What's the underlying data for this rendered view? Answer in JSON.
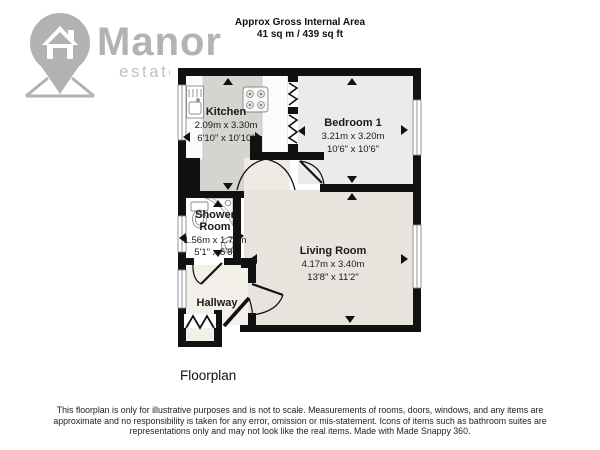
{
  "header": {
    "title": "Approx Gross Internal Area",
    "area": "41 sq m / 439 sq ft"
  },
  "logo": {
    "name": "Manor",
    "tagline": "estate agents"
  },
  "rooms": {
    "kitchen": {
      "name": "Kitchen",
      "metric": "2.09m x 3.30m",
      "imperial": "6'10\" x 10'10\""
    },
    "bedroom1": {
      "name": "Bedroom 1",
      "metric": "3.21m x 3.20m",
      "imperial": "10'6\" x 10'6\""
    },
    "shower": {
      "name_line1": "Shower",
      "name_line2": "Room",
      "metric": "1.56m x 1.72m",
      "imperial": "5'1\" x 5'8\""
    },
    "living": {
      "name": "Living Room",
      "metric": "4.17m x 3.40m",
      "imperial": "13'8\" x 11'2\""
    },
    "hallway": {
      "name": "Hallway"
    }
  },
  "caption": "Floorplan",
  "disclaimer": "This floorplan is only for illustrative purposes and is not to scale. Measurements of rooms, doors, windows, and any items are approximate and no responsibility is taken for any error, omission or mis-statement. Icons of items such as bathroom suites are representations only and may not look like the real items. Made with Made Snappy 360.",
  "colors": {
    "wall": "#111111",
    "kitchen_floor": "#d5d4d1",
    "bedroom_floor": "#ebebe9",
    "living_floor": "#e8e4dd",
    "nook_floor": "#efebe4",
    "hallway_floor": "#f3f0e9",
    "shower_floor": "#ffffff",
    "logo_gray": "#b3b3b3"
  }
}
